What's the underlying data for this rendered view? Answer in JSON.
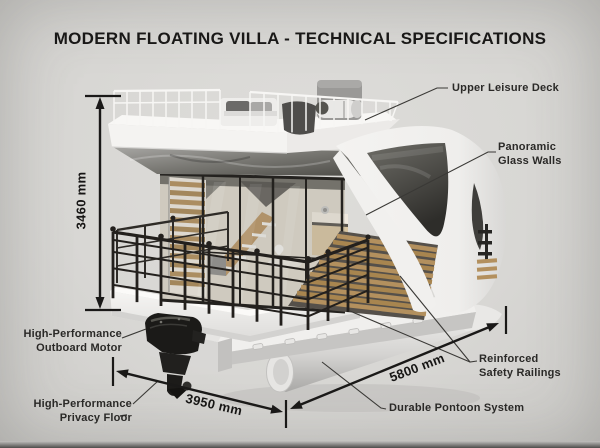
{
  "title": "MODERN FLOATING VILLA - TECHNICAL SPECIFICATIONS",
  "labels": {
    "upper_deck": "Upper Leisure Deck",
    "glass_walls_1": "Panoramic",
    "glass_walls_2": "Glass Walls",
    "motor_1": "High-Performance",
    "motor_2": "Outboard Motor",
    "privacy_1": "High-Performance",
    "privacy_2": "Privacy Floor",
    "railings_1": "Reinforced",
    "railings_2": "Safety Railings",
    "pontoon": "Durable Pontoon System"
  },
  "dimensions": {
    "height": "3460 mm",
    "beam": "3950 mm",
    "length": "5800 mm"
  },
  "illustration": {
    "subject": "3D render of a two-deck floating villa on cylindrical pontoons",
    "parts": [
      "upper-leisure-deck",
      "panoramic-glass-walls",
      "reinforced-safety-railings",
      "wood-slat-privacy-walls",
      "outboard-motor",
      "pontoon-system",
      "balcony-railing",
      "roof-deck-furniture"
    ]
  },
  "colors": {
    "background": "#d8d7d4",
    "ink": "#191817",
    "label_text": "#2a2927",
    "villa_white": "#f2f1ef",
    "wood": "#b3905e",
    "railing_black": "#23201d",
    "glass_dark": "#3c3b38",
    "pontoon_gray": "#e5e4e2"
  }
}
